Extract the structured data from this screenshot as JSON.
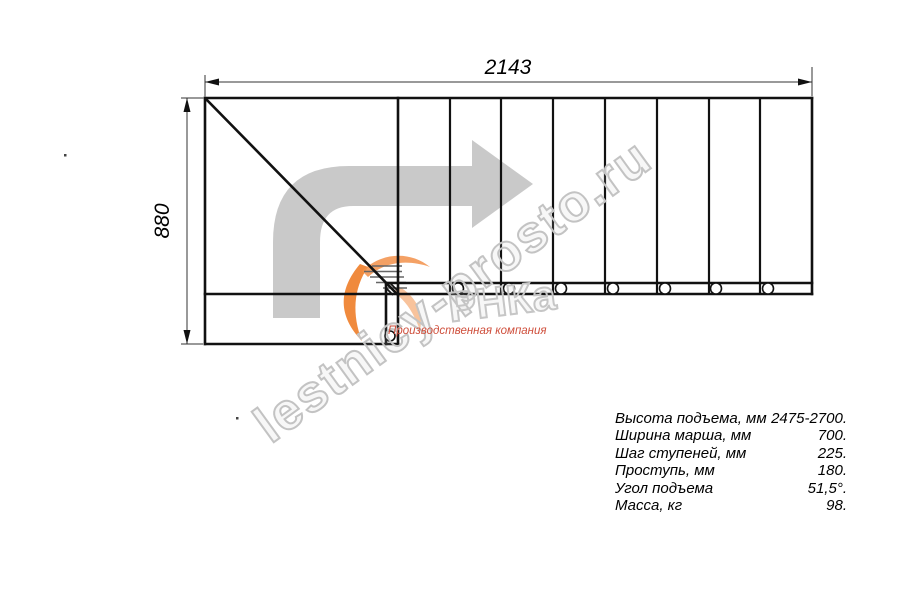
{
  "drawing": {
    "title": "stair-plan-top-view",
    "dimensions": {
      "width_label": "2143",
      "height_label": "880"
    },
    "straight_treads": 8,
    "screw_marks": 8
  },
  "watermark": {
    "diagonal_text": "lestnicy-prosto.ru",
    "logo_fragment": "РНКа",
    "tagline": "Производственная компания"
  },
  "specs": {
    "rows": [
      {
        "label": "Высота подъема, мм",
        "value": "2475-2700."
      },
      {
        "label": "Ширина марша, мм",
        "value": "700."
      },
      {
        "label": "Шаг ступеней, мм",
        "value": "225."
      },
      {
        "label": "Проступь, мм",
        "value": "180."
      },
      {
        "label": "Угол подъема",
        "value": "51,5°."
      },
      {
        "label": "Масса, кг",
        "value": "98."
      }
    ]
  },
  "colors": {
    "line": "#111111",
    "dimension": "#333333",
    "arrow_gray": "#c9c9c9",
    "watermark_gray": "#c3c3c3",
    "logo_orange": "#ee7d28",
    "tagline_red": "#cf4f3c"
  }
}
